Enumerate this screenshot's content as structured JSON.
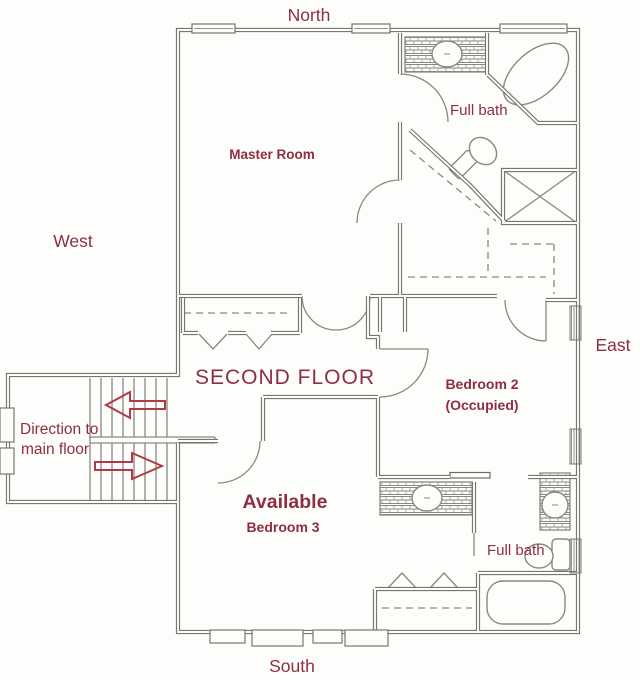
{
  "title": "Second floor plan",
  "floor_label": "SECOND FLOOR",
  "compass": {
    "north": "North",
    "west": "West",
    "east": "East",
    "south": "South"
  },
  "rooms": {
    "master": {
      "label": "Master Room"
    },
    "bedroom2": {
      "label": "Bedroom 2",
      "status": "(Occupied)"
    },
    "bedroom3": {
      "status": "Available",
      "label": "Bedroom 3"
    },
    "bath_upper": {
      "label": "Full bath"
    },
    "bath_lower": {
      "label": "Full bath"
    }
  },
  "stairs": {
    "note_line1": "Direction to",
    "note_line2": "main floor",
    "upper_flight_arrow": "left",
    "lower_flight_arrow": "right"
  },
  "colors": {
    "label_text": "#8e2f3f",
    "arrow": "#b23a45",
    "wall": "#79766d",
    "background": "#fdfdfc"
  }
}
